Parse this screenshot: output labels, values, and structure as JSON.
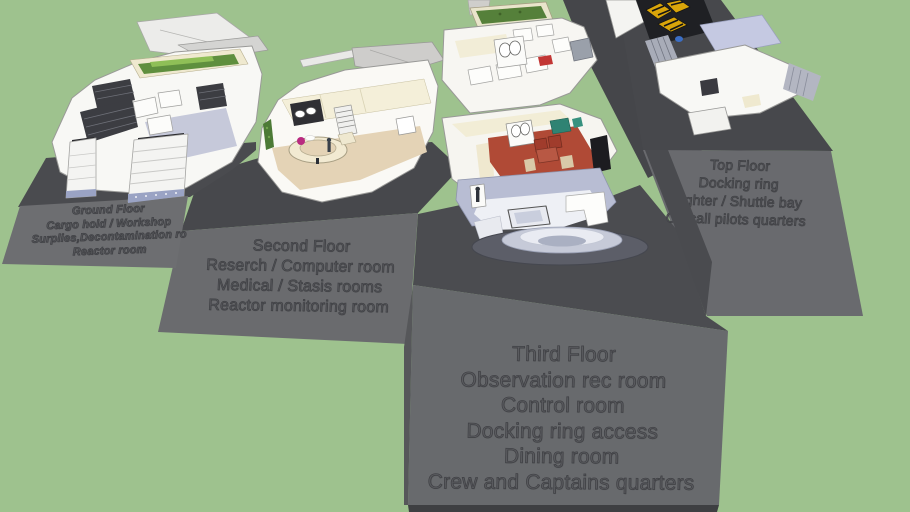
{
  "scene": {
    "background_color": "#9ec28e",
    "platform_face_color": "#6a6b6e",
    "platform_top_color": "#4a4b4f",
    "label_text_color": "#5a5b5f",
    "palette": {
      "hull_white": "#f8f8f5",
      "floor_tan": "#e4d3b6",
      "floor_lavender": "#c6c9da",
      "dining_red": "#b04a36",
      "garden_green": "#5f8f3e",
      "fighter_yellow": "#d9a50a",
      "dome_gray": "#5c5e68"
    }
  },
  "floors": [
    {
      "id": "ground-floor",
      "lines": [
        "Ground Floor",
        "Cargo hold / Workshop",
        "Surplies,Decontamination ro",
        "Reactor room"
      ]
    },
    {
      "id": "second-floor",
      "lines": [
        "Second Floor",
        "Reserch / Computer room",
        "Medical / Stasis rooms",
        "Reactor monitoring room"
      ]
    },
    {
      "id": "third-floor",
      "lines": [
        "Third Floor",
        "Observation rec room",
        "Control room",
        "Docking ring access",
        "Dining room",
        "Crew and Captains quarters"
      ]
    },
    {
      "id": "top-floor",
      "lines": [
        "Top Floor",
        "Docking ring",
        "Fighter / Shuttle bay",
        "On call pilots quarters"
      ]
    }
  ]
}
